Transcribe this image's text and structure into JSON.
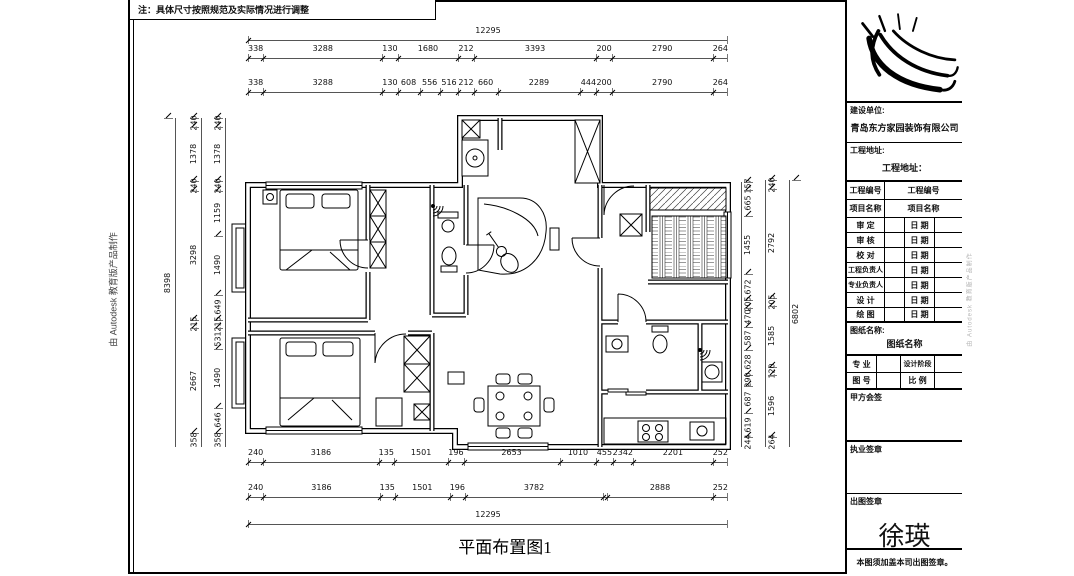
{
  "note": "注：具体尺寸按照规范及实际情况进行调整",
  "watermark_left": "由 Autodesk 教育版产品制作",
  "watermark_right": "由 Autodesk 教育版产品制作",
  "caption": "平面布置图1",
  "dims": {
    "top_overall": [
      [
        "12295",
        12295
      ]
    ],
    "top_row1": [
      [
        "338",
        338
      ],
      [
        "3288",
        3288
      ],
      [
        "130",
        130
      ],
      [
        "1680",
        1680
      ],
      [
        "212",
        212
      ],
      [
        "3393",
        3393
      ],
      [
        "200",
        200
      ],
      [
        "2790",
        2790
      ],
      [
        "264",
        264
      ]
    ],
    "top_row2": [
      [
        "338",
        338
      ],
      [
        "3288",
        3288
      ],
      [
        "130",
        130
      ],
      [
        "608",
        608
      ],
      [
        "556",
        556
      ],
      [
        "516",
        516
      ],
      [
        "212",
        212
      ],
      [
        "660",
        660
      ],
      [
        "2289",
        2289
      ],
      [
        "444",
        444
      ],
      [
        "200",
        200
      ],
      [
        "2790",
        2790
      ],
      [
        "264",
        264
      ]
    ],
    "bottom_row1": [
      [
        "240",
        240
      ],
      [
        "3186",
        3186
      ],
      [
        "135",
        135
      ],
      [
        "1501",
        1501
      ],
      [
        "196",
        196
      ],
      [
        "2653",
        2653
      ],
      [
        "1010",
        1010
      ],
      [
        "455",
        455
      ],
      [
        "2342",
        466
      ],
      [
        "2201",
        2201
      ],
      [
        "252",
        252
      ]
    ],
    "bottom_row2": [
      [
        "240",
        240
      ],
      [
        "3186",
        3186
      ],
      [
        "135",
        135
      ],
      [
        "1501",
        1501
      ],
      [
        "196",
        196
      ],
      [
        "3782",
        3782
      ],
      [
        "",
        115
      ],
      [
        "2888",
        2888
      ],
      [
        "252",
        252
      ]
    ],
    "bottom_overall": [
      [
        "12295",
        12295
      ]
    ],
    "left_overall": [
      [
        "8398",
        8398
      ]
    ],
    "left_outer": [
      [
        "240",
        240
      ],
      [
        "1378",
        1378
      ],
      [
        "240",
        240
      ],
      [
        "3298",
        3298
      ],
      [
        "215",
        215
      ],
      [
        "2667",
        2667
      ],
      [
        "358",
        358
      ]
    ],
    "left_inner": [
      [
        "240",
        240
      ],
      [
        "1378",
        1378
      ],
      [
        "240",
        240
      ],
      [
        "1159",
        1159
      ],
      [
        "1490",
        1490
      ],
      [
        "649",
        649
      ],
      [
        "215",
        215
      ],
      [
        "531",
        531
      ],
      [
        "1490",
        1490
      ],
      [
        "646",
        646
      ],
      [
        "358",
        358
      ]
    ],
    "right_a": [
      [
        "157",
        157
      ],
      [
        "665",
        665
      ],
      [
        "1455",
        1455
      ],
      [
        "672",
        672
      ],
      [
        "205",
        205
      ],
      [
        "470",
        470
      ],
      [
        "587",
        587
      ],
      [
        "628",
        628
      ],
      [
        "290",
        290
      ],
      [
        "687",
        687
      ],
      [
        "619",
        619
      ],
      [
        "244",
        244
      ]
    ],
    "right_b": [
      [
        "240",
        240
      ],
      [
        "2792",
        2792
      ],
      [
        "205",
        205
      ],
      [
        "1585",
        1585
      ],
      [
        "120",
        120
      ],
      [
        "1596",
        1596
      ],
      [
        "264",
        264
      ]
    ],
    "right_c": [
      [
        "6802",
        6802
      ]
    ]
  },
  "titleblock": {
    "unit_label": "建设单位:",
    "company": "青岛东方家园装饰有限公司",
    "address_label": "工程地址:",
    "address_value": "工程地址：",
    "info_rows": [
      {
        "label": "工程编号",
        "value": "工程编号"
      },
      {
        "label": "项目名称",
        "value": "项目名称"
      }
    ],
    "sign_rows": [
      {
        "label": "审 定",
        "date": "日 期"
      },
      {
        "label": "审 核",
        "date": "日 期"
      },
      {
        "label": "校 对",
        "date": "日 期"
      },
      {
        "label": "工程负责人",
        "date": "日 期"
      },
      {
        "label": "专业负责人",
        "date": "日 期"
      },
      {
        "label": "设 计",
        "date": "日 期"
      },
      {
        "label": "绘 图",
        "date": "日 期"
      }
    ],
    "sheet_name_label": "图纸名称:",
    "sheet_name_value": "图纸名称",
    "major_label": "专 业",
    "stage_label": "设计阶段",
    "figno_label": "图 号",
    "scale_label": "比 例",
    "party_sign": "甲方会签",
    "practice_seal": "执业签章",
    "issue_seal": "出图签章",
    "signature": "徐瑛",
    "footer": "本图须加盖本司出图签章。"
  }
}
